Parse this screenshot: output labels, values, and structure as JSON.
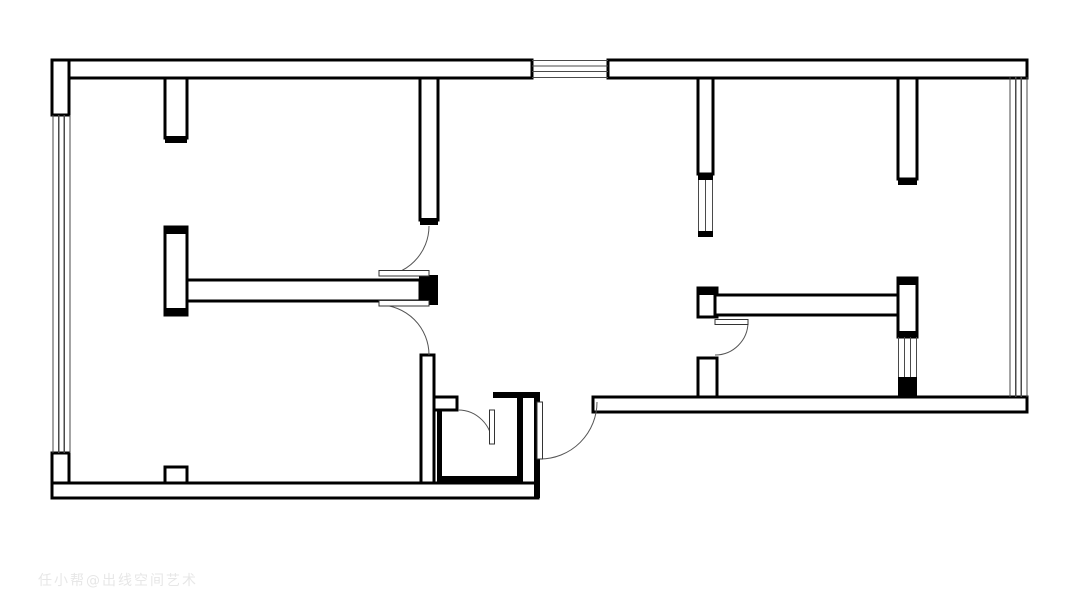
{
  "meta": {
    "title": "apartment-floor-plan",
    "canvas_width": 1080,
    "canvas_height": 607,
    "background_color": "#ffffff",
    "wall_color": "#000000",
    "wall_stroke_width": 2.6,
    "window_line_color": "#4a4a4a",
    "door_arc_color": "#555555",
    "door_leaf_stroke": "#333333"
  },
  "watermark": {
    "text": "任小帮@出线空间艺术"
  },
  "plan": {
    "hollow_walls": [
      {
        "x": 52,
        "y": 60,
        "w": 480,
        "h": 18
      },
      {
        "x": 608,
        "y": 60,
        "w": 419,
        "h": 18
      },
      {
        "x": 52,
        "y": 60,
        "w": 17,
        "h": 55
      },
      {
        "x": 52,
        "y": 453,
        "w": 17,
        "h": 45
      },
      {
        "x": 52,
        "y": 483,
        "w": 486,
        "h": 15
      },
      {
        "x": 165,
        "y": 467,
        "w": 22,
        "h": 16
      },
      {
        "x": 165,
        "y": 78,
        "w": 22,
        "h": 60
      },
      {
        "x": 420,
        "y": 78,
        "w": 18,
        "h": 142
      },
      {
        "x": 165,
        "y": 227,
        "w": 22,
        "h": 88
      },
      {
        "x": 187,
        "y": 280,
        "w": 233,
        "h": 21
      },
      {
        "x": 421,
        "y": 355,
        "w": 13,
        "h": 128
      },
      {
        "x": 434,
        "y": 397,
        "w": 23,
        "h": 13
      },
      {
        "x": 593,
        "y": 397,
        "w": 434,
        "h": 15
      },
      {
        "x": 698,
        "y": 78,
        "w": 15,
        "h": 96
      },
      {
        "x": 698,
        "y": 288,
        "w": 19,
        "h": 29
      },
      {
        "x": 698,
        "y": 358,
        "w": 19,
        "h": 39
      },
      {
        "x": 715,
        "y": 295,
        "w": 187,
        "h": 20
      },
      {
        "x": 898,
        "y": 278,
        "w": 19,
        "h": 59
      },
      {
        "x": 898,
        "y": 78,
        "w": 19,
        "h": 101
      }
    ],
    "solid_walls": [
      {
        "x": 165,
        "y": 136,
        "w": 22,
        "h": 7
      },
      {
        "x": 420,
        "y": 218,
        "w": 18,
        "h": 7
      },
      {
        "x": 165,
        "y": 227,
        "w": 22,
        "h": 7
      },
      {
        "x": 165,
        "y": 308,
        "w": 22,
        "h": 7
      },
      {
        "x": 419,
        "y": 275,
        "w": 19,
        "h": 30
      },
      {
        "x": 437,
        "y": 410,
        "w": 5,
        "h": 73
      },
      {
        "x": 437,
        "y": 476,
        "w": 86,
        "h": 7
      },
      {
        "x": 517,
        "y": 398,
        "w": 6,
        "h": 85
      },
      {
        "x": 493,
        "y": 392,
        "w": 47,
        "h": 6
      },
      {
        "x": 534,
        "y": 392,
        "w": 6,
        "h": 106
      },
      {
        "x": 698,
        "y": 174,
        "w": 15,
        "h": 6
      },
      {
        "x": 698,
        "y": 231,
        "w": 15,
        "h": 6
      },
      {
        "x": 698,
        "y": 288,
        "w": 19,
        "h": 7
      },
      {
        "x": 898,
        "y": 278,
        "w": 19,
        "h": 7
      },
      {
        "x": 898,
        "y": 331,
        "w": 19,
        "h": 6
      },
      {
        "x": 898,
        "y": 377,
        "w": 19,
        "h": 20
      },
      {
        "x": 898,
        "y": 179,
        "w": 19,
        "h": 6
      }
    ],
    "windows": [
      {
        "orientation": "v",
        "fixed": [
          53,
          58.7,
          64.3,
          70
        ],
        "from": 115,
        "to": 453
      },
      {
        "orientation": "h",
        "fixed": [
          60.5,
          66,
          71.5,
          77.5
        ],
        "from": 532,
        "to": 608
      },
      {
        "orientation": "v",
        "fixed": [
          1010,
          1015.7,
          1021.3,
          1027
        ],
        "from": 77,
        "to": 397
      },
      {
        "orientation": "v",
        "fixed": [
          698.5,
          705.5,
          712.5
        ],
        "from": 180,
        "to": 231
      },
      {
        "orientation": "v",
        "fixed": [
          898.5,
          904.5,
          910.5,
          916.5
        ],
        "from": 337,
        "to": 377
      }
    ],
    "doors": [
      {
        "name": "door-north-bedroom",
        "leaf": {
          "x": 379,
          "y": 270.5,
          "w": 50,
          "h": 5.5
        },
        "arc": {
          "x1": 379,
          "y1": 276,
          "x2": 429,
          "y2": 226,
          "r": 50,
          "sweep": 0
        }
      },
      {
        "name": "door-living-room",
        "leaf": {
          "x": 379,
          "y": 300.5,
          "w": 50,
          "h": 5.5
        },
        "arc": {
          "x1": 379,
          "y1": 305,
          "x2": 429,
          "y2": 355,
          "r": 50,
          "sweep": 1
        }
      },
      {
        "name": "door-bathroom",
        "leaf": {
          "x": 489.5,
          "y": 410,
          "w": 5,
          "h": 34
        },
        "arc": {
          "x1": 458,
          "y1": 410,
          "x2": 492,
          "y2": 444,
          "r": 34,
          "sweep": 1
        }
      },
      {
        "name": "door-entrance",
        "leaf": {
          "x": 537,
          "y": 402,
          "w": 5.5,
          "h": 57
        },
        "arc": {
          "x1": 540,
          "y1": 459,
          "x2": 597,
          "y2": 402,
          "r": 57,
          "sweep": 0
        }
      },
      {
        "name": "door-study",
        "leaf": {
          "x": 715,
          "y": 319.5,
          "w": 33,
          "h": 5
        },
        "arc": {
          "x1": 748,
          "y1": 322,
          "x2": 715,
          "y2": 355,
          "r": 33,
          "sweep": 1
        }
      }
    ]
  }
}
